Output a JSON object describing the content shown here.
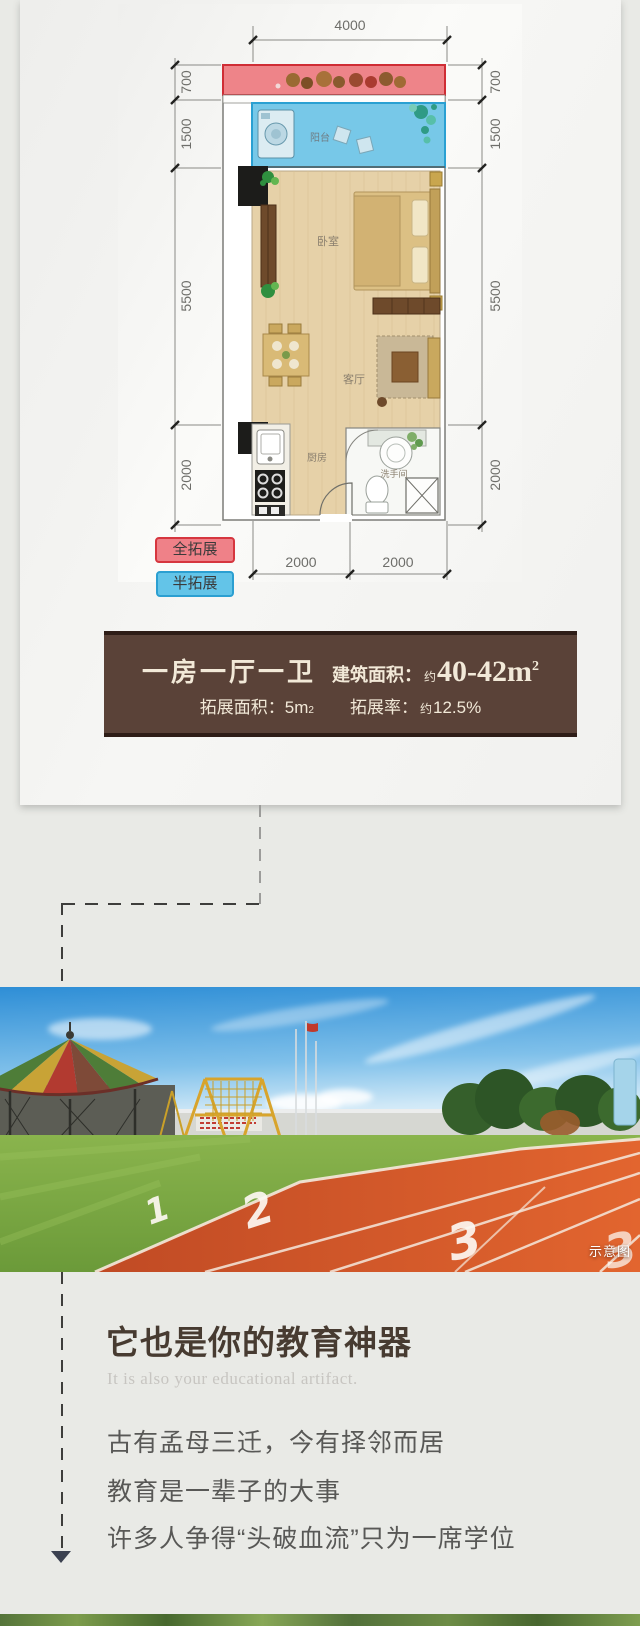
{
  "card": {
    "floor_plan": {
      "dim_top": "4000",
      "dims_left": [
        "700",
        "1500",
        "5500",
        "2000"
      ],
      "dims_right": [
        "700",
        "1500",
        "5500",
        "2000"
      ],
      "dims_bottom": [
        "2000",
        "2000"
      ],
      "rooms": {
        "balcony": "阳台",
        "bedroom": "卧室",
        "living_room": "客厅",
        "kitchen": "厨房",
        "bathroom": "洗手间"
      },
      "legend": {
        "full_expand": "全拓展",
        "half_expand": "半拓展"
      },
      "colors": {
        "full_expand_fill": "#ef8188",
        "full_expand_border": "#d6363f",
        "half_expand_fill": "#63c4e8",
        "half_expand_border": "#2b9fd1"
      }
    },
    "info_box": {
      "bg": "#5a4238",
      "unit_type": "一房一厅一卫",
      "built_area_label": "建筑面积：",
      "approx": "约",
      "built_area_value": "40-42m",
      "sup": "2",
      "expand_area_label": "拓展面积：",
      "expand_area_value": "5m",
      "expand_rate_label": "拓展率：",
      "expand_rate_approx": "约",
      "expand_rate_value": "12.5%"
    }
  },
  "photo": {
    "watermark": "示意图",
    "lane_numbers": [
      "1",
      "2",
      "3"
    ]
  },
  "edu_section": {
    "title": "它也是你的教育神器",
    "subtitle": "It is also your educational artifact.",
    "line1": "古有孟母三迁，今有择邻而居",
    "line2": "教育是一辈子的大事",
    "line3": "许多人争得“头破血流”只为一席学位"
  }
}
